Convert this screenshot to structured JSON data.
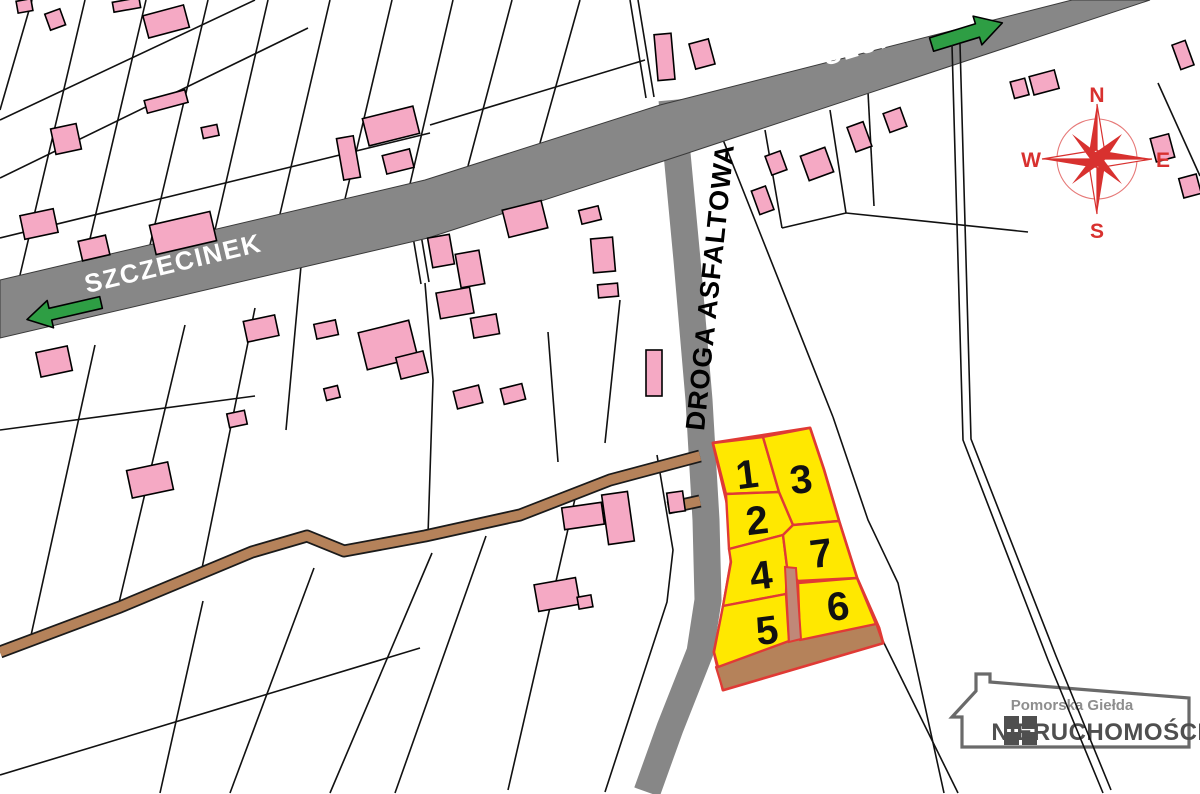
{
  "road_labels": {
    "west_direction": "SZCZECINEK",
    "east_direction": "SŁUPSK",
    "side_road": "DROGA ASFALTOWA"
  },
  "plots": {
    "numbers": [
      "1",
      "2",
      "3",
      "4",
      "5",
      "6",
      "7"
    ]
  },
  "compass": {
    "north": "N",
    "east": "E",
    "south": "S",
    "west": "W"
  },
  "logo": {
    "subtitle": "Pomorska Giełda",
    "title": "NIERUCHOMOŚCI"
  },
  "colors": {
    "road": "#878787",
    "pink": "#F5A9C4",
    "yellow": "#FFE800",
    "red": "#E03A35",
    "brown": "#B5825A",
    "drive": "#C08878",
    "green": "#2E9E44",
    "compass": "#D8312F",
    "logo_stroke": "#6A6A6A",
    "logo_text": "#4F4F4F",
    "logo_subtext": "#8E8E8E"
  }
}
